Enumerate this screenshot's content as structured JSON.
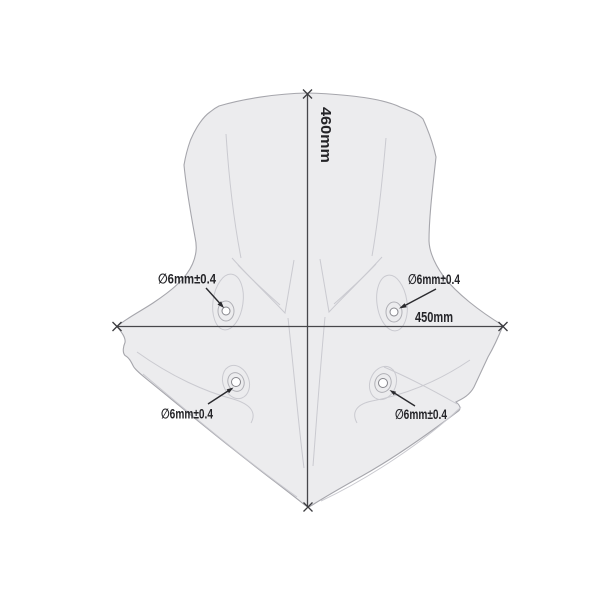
{
  "diagram": {
    "canvas": {
      "width": 600,
      "height": 600,
      "background": "#ffffff"
    },
    "height_dimension": {
      "label": "460mm",
      "orientation": "vertical"
    },
    "width_dimension": {
      "label": "450mm",
      "orientation": "horizontal"
    },
    "holes": {
      "top_left": {
        "label": "∅6mm±0.4"
      },
      "top_right": {
        "label": "∅6mm±0.4"
      },
      "bottom_left": {
        "label": "∅6mm±0.4"
      },
      "bottom_right": {
        "label": "∅6mm±0.4"
      }
    },
    "colors": {
      "screen_fill": "#ececee",
      "screen_outline": "#a6a6ac",
      "crease_line": "#cacad0",
      "dimension_line": "#47474b",
      "annotation": "#2b2b2f"
    }
  }
}
